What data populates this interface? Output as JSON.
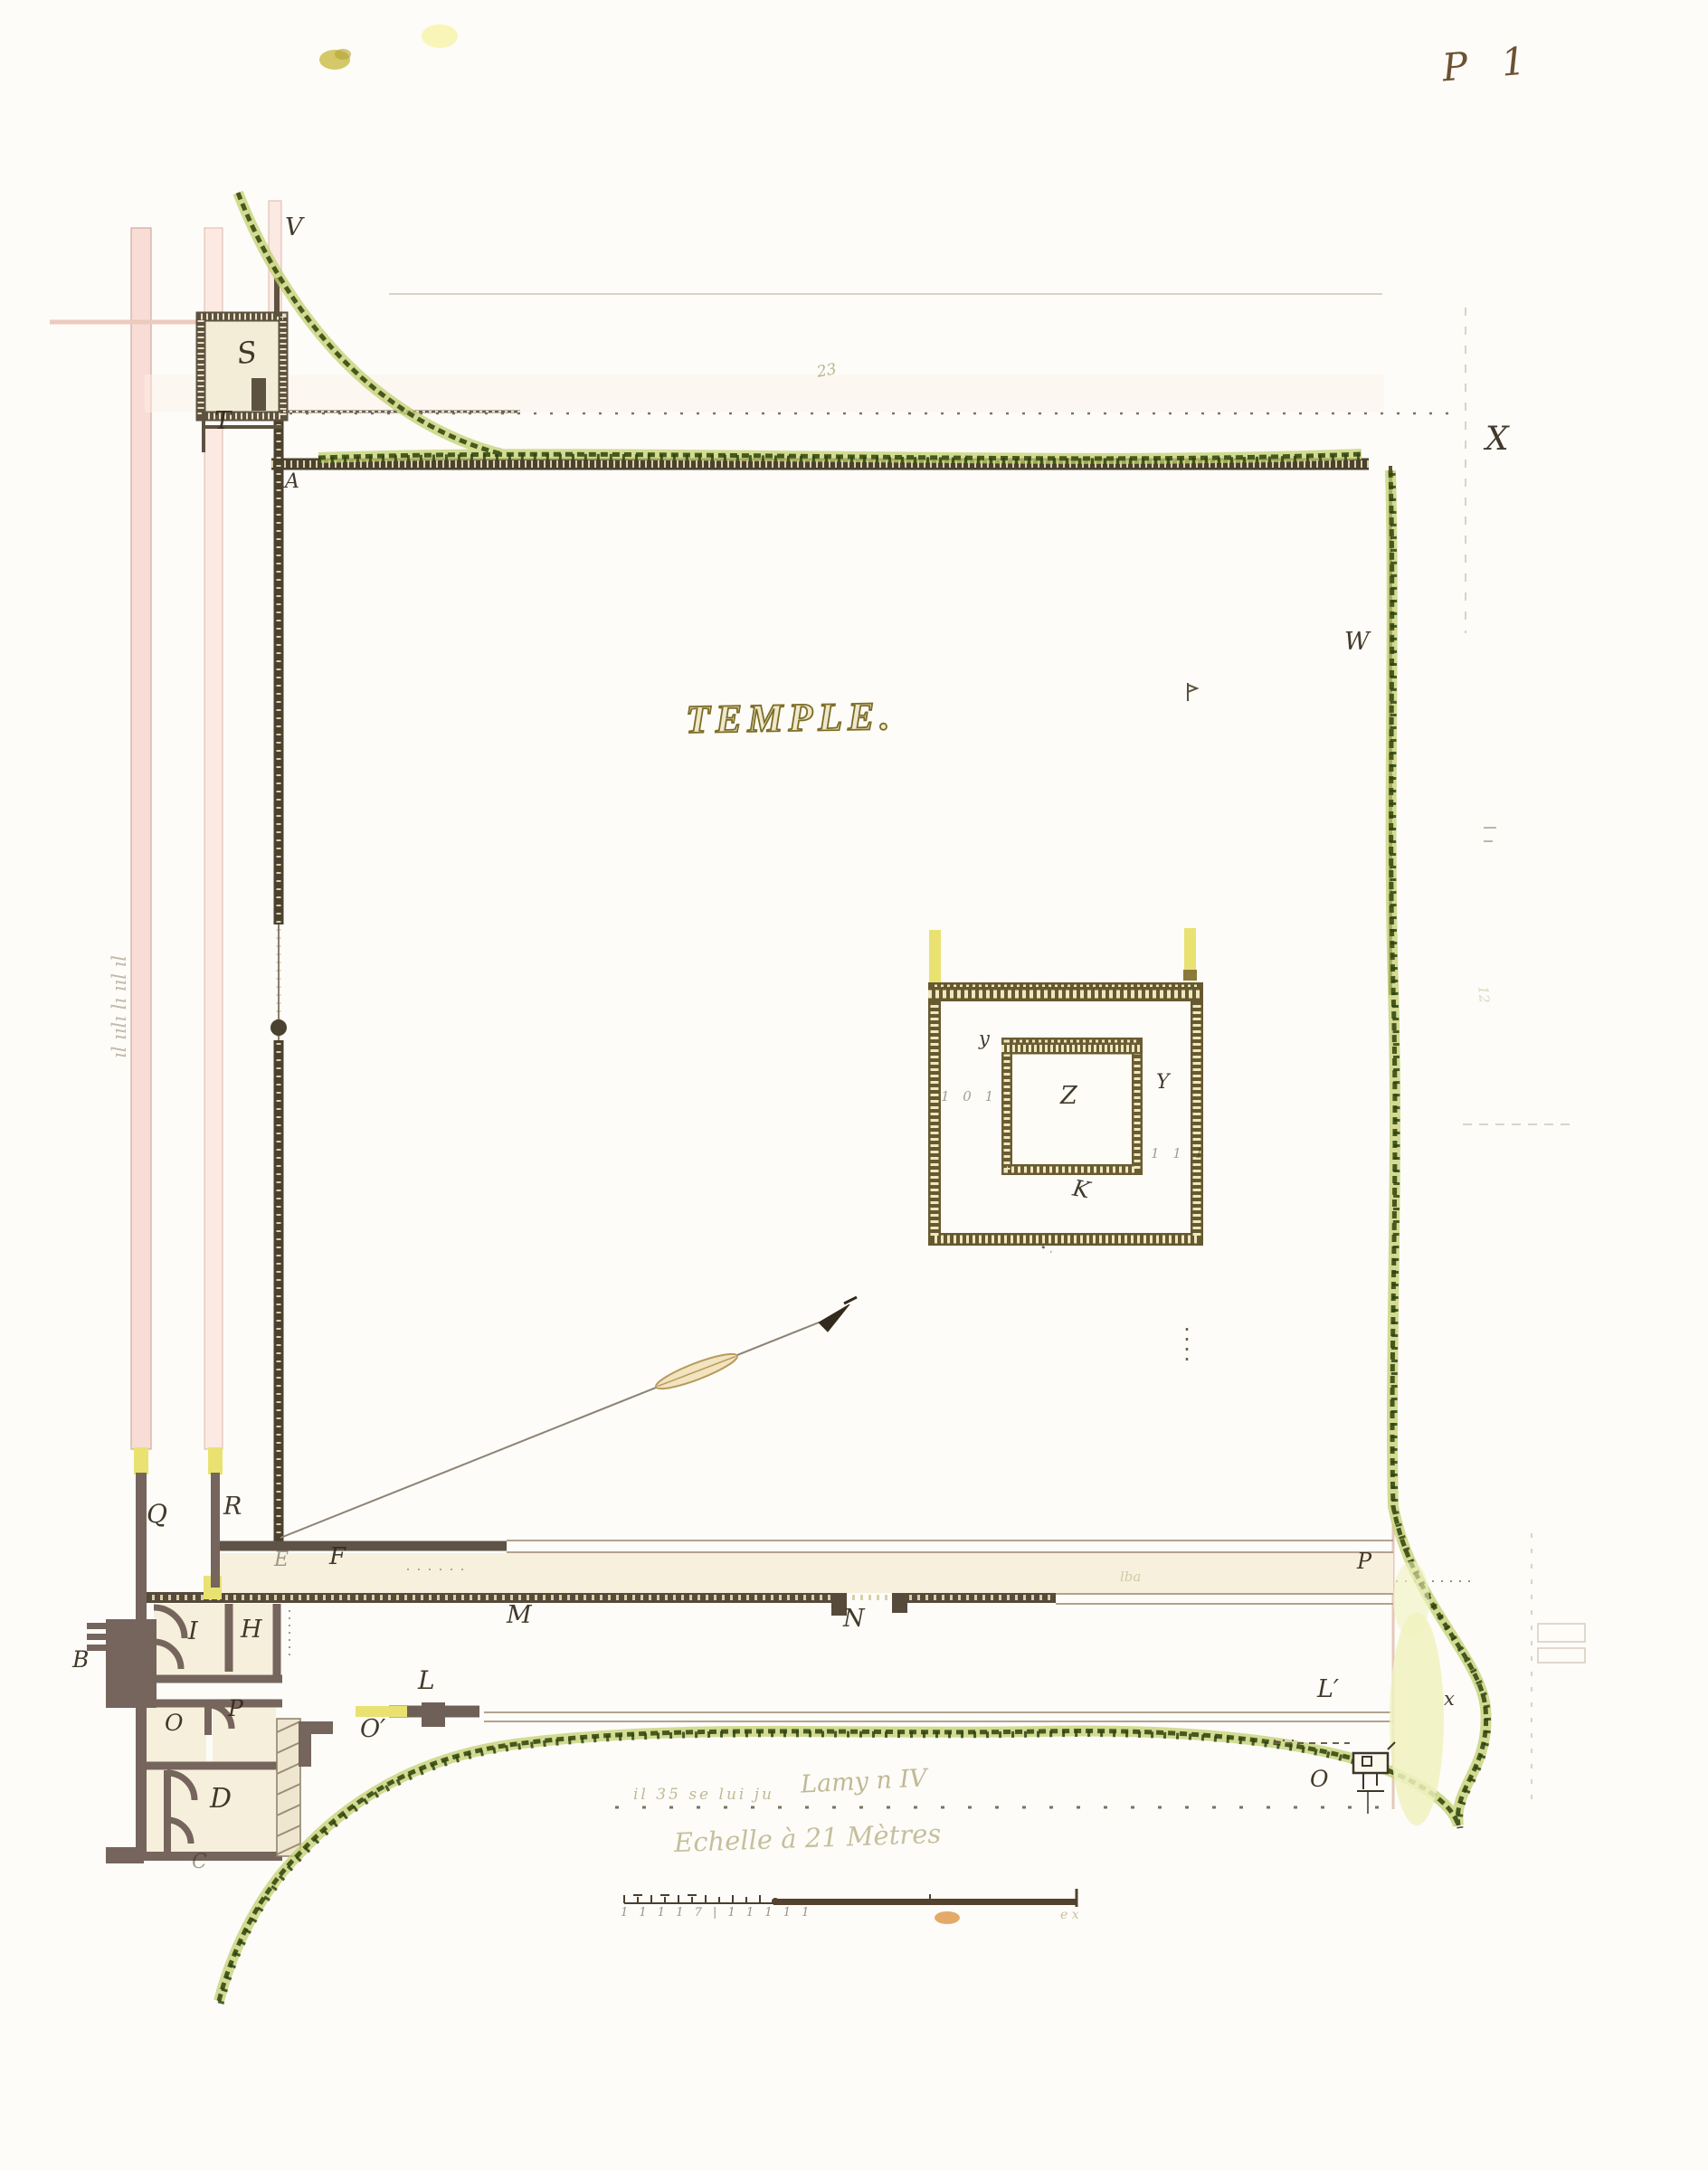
{
  "plate": "P 1",
  "title": "TEMPLE.",
  "labels": {
    "V": "V",
    "S": "S",
    "T": "T",
    "A": "A",
    "X": "X",
    "W": "W",
    "Q": "Q",
    "R": "R",
    "E": "E",
    "F": "F",
    "M": "M",
    "N": "N",
    "P_road": "P",
    "L": "L",
    "L_prime": "L′",
    "O_prime": "O′",
    "I": "I",
    "H": "H",
    "O_room": "O",
    "P_room": "P",
    "D": "D",
    "C": "C",
    "B": "B",
    "x_small": "x",
    "O_kiosk": "O",
    "Z": "Z",
    "y_left": "y",
    "Y_right": "Y",
    "K": "K",
    "ticks_left": "1 0 1",
    "ticks_right": "1 1 1"
  },
  "annotations": {
    "road_note": "il 35   se lui ju",
    "middle": "Lamy n IV",
    "scale_caption": "Echelle à 21 Mètres",
    "left_margin": "ıl ıılı lı ııl ıl",
    "numerals": "1 1 1 1 7 | 1 1 1 1 1",
    "mark_23": "23",
    "mark_lba": "lba",
    "mark_12": "12",
    "mark_ex": "e x"
  },
  "colors": {
    "paper": "#fdfcf8",
    "wall_dark": "#4a4130",
    "wall_mauve": "#75655c",
    "stipple_olive": "#66592f",
    "hedge_dark": "#47581d",
    "hedge_light": "#c3d070",
    "road_pink": "#f7dcd4",
    "column_yellow": "#e9e271",
    "wash_yellow": "#f0f2c0",
    "title_olive": "#94842e",
    "ink_brown": "#33291a"
  }
}
